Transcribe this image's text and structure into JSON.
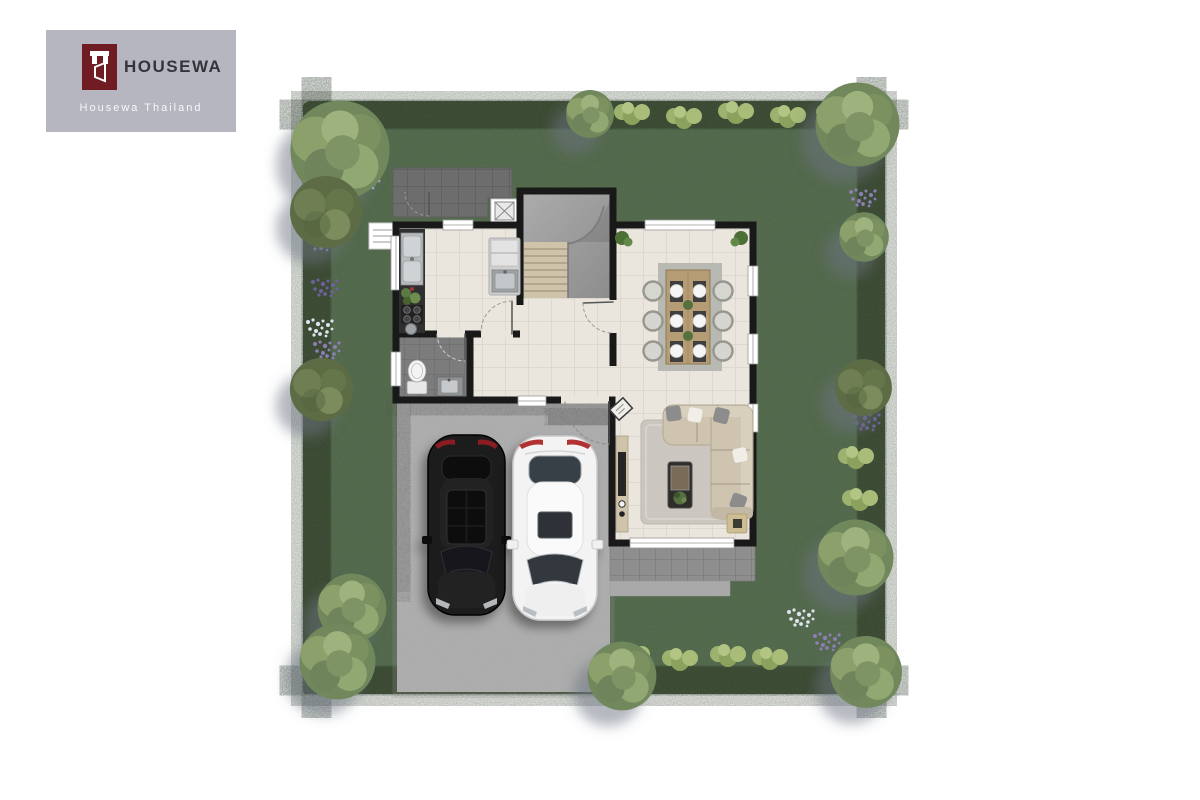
{
  "brand": {
    "name": "HOUSEWA",
    "tagline": "Housewa Thailand",
    "mark_icon": "housewa-door-monogram",
    "card_bg": "#b5b6bf",
    "mark_color": "#701c23",
    "name_color": "#34353c",
    "tagline_color": "#f7f7fa"
  },
  "scene": {
    "type": "residential site plan, first floor, top-down 3D render",
    "background": "#ffffff",
    "palette": {
      "lawn": "#5d7557",
      "hedge": "#47573e",
      "bush": "#9cb06c",
      "floor": "#eae6de",
      "wall": "#191919",
      "driveway": "#b6b6b6",
      "service_patio": "#6d6d6d",
      "terrace": "#8e8e8e",
      "bathroom_floor": "#7c7c7c",
      "wood": "#b59c74",
      "sofa": "#cec4b0",
      "rug": "#cbc7c0"
    },
    "plot": {
      "tree_count": 12,
      "flower_colors": [
        "#8d7fb5",
        "#dfe3ee",
        "#7d8fc0"
      ],
      "hedge_sides": [
        "top",
        "left",
        "right",
        "bottom"
      ]
    },
    "house": {
      "rooms": [
        {
          "id": "kitchen",
          "position": "north-west",
          "features": [
            "double-basin sink",
            "herb planter",
            "4-burner cooktop",
            "round prep sink",
            "island with refrigerator and sink"
          ]
        },
        {
          "id": "stair-hall",
          "position": "north-center",
          "features": [
            "staircase with 8 wood treads",
            "concrete landing"
          ]
        },
        {
          "id": "dining-room",
          "position": "north-east",
          "features": [
            "6-seat dining table",
            "6 place settings",
            "2 table plants",
            "2 corner floor plants"
          ]
        },
        {
          "id": "bathroom",
          "position": "west",
          "features": [
            "toilet",
            "vanity sink"
          ]
        },
        {
          "id": "hallway",
          "position": "center",
          "features": [
            "entry door to driveway",
            "entry wall art"
          ]
        },
        {
          "id": "living-room",
          "position": "south-east",
          "features": [
            "L-shaped sectional sofa",
            "area rug",
            "coffee table with plant",
            "TV console",
            "side table"
          ]
        }
      ],
      "openings": {
        "windows": 9,
        "doors": 5
      }
    },
    "outdoor": {
      "service_patio": "north-west outside kitchen",
      "ac_pads": 2,
      "terrace": "south of living room",
      "driveway": {
        "position": "south-west",
        "parking_spaces": 2
      },
      "vehicles": [
        {
          "type": "sedan",
          "color": "black"
        },
        {
          "type": "sedan",
          "color": "white"
        }
      ]
    }
  }
}
